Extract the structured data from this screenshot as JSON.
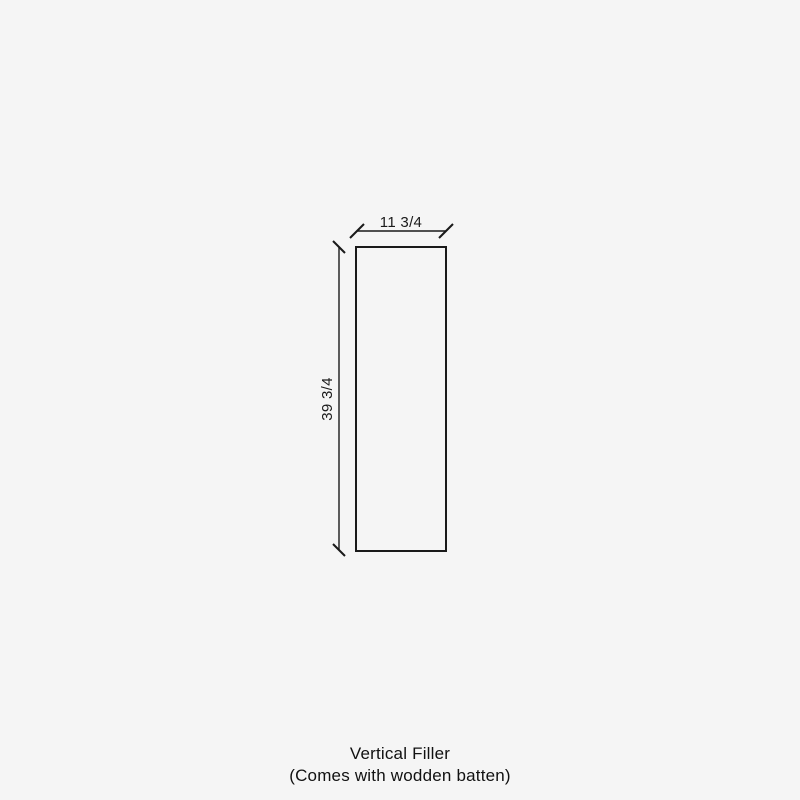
{
  "canvas": {
    "background_color": "#f5f5f5",
    "line_color": "#1a1a1a",
    "text_color": "#111111"
  },
  "diagram": {
    "shape": "vertical-filler-panel",
    "width_label": "11 3/4",
    "height_label": "39 3/4"
  },
  "caption": {
    "line1": "Vertical Filler",
    "line2": "(Comes with wodden batten)"
  }
}
